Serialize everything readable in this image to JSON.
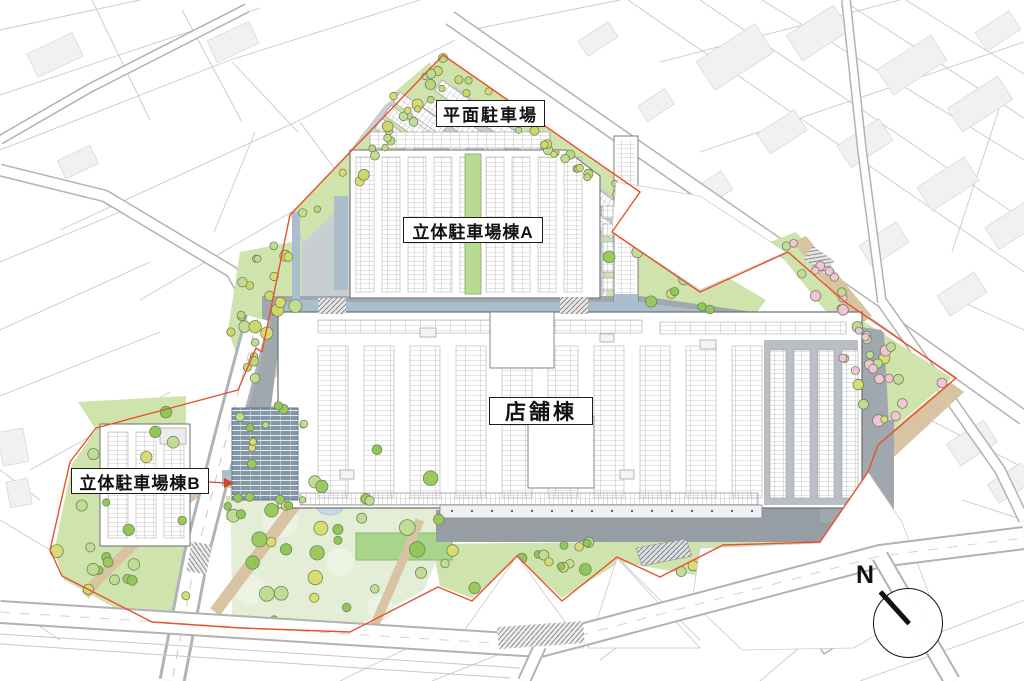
{
  "plan": {
    "labels": {
      "surface_parking": "平面駐車場",
      "parking_structure_a": "立体駐車場棟A",
      "store_building": "店舗棟",
      "parking_structure_b": "立体駐車場棟B"
    },
    "compass": {
      "north": "N"
    },
    "colors": {
      "site_boundary": "#e8512d",
      "road_gray": "#a0a7ae",
      "road_dark": "#969da4",
      "parking_asphalt": "#c9ced3",
      "walkway_blue": "#aabecb",
      "annex_blue": "#8298a6",
      "green_light": "#cfe3ad",
      "park_base": "#e4eed6",
      "lawn": "#a8d589",
      "mound": "#edf3e2",
      "tree_green": "#8fc858",
      "tree_light": "#c0dd96",
      "tree_yellow": "#d9dc72",
      "tree_pink": "#f2c3d9",
      "tree_outline": "#75845c",
      "path_tan": "#d8c3a3",
      "pond_blue": "#c2dce6",
      "context_line": "#c9c9c9",
      "context_fill": "#f1f1f1",
      "context_road": "#b2b2b2",
      "building_outline": "#6f6f6f",
      "stall_line": "#979797",
      "canopy": "#eef1f4",
      "hatch": "#777777"
    }
  }
}
